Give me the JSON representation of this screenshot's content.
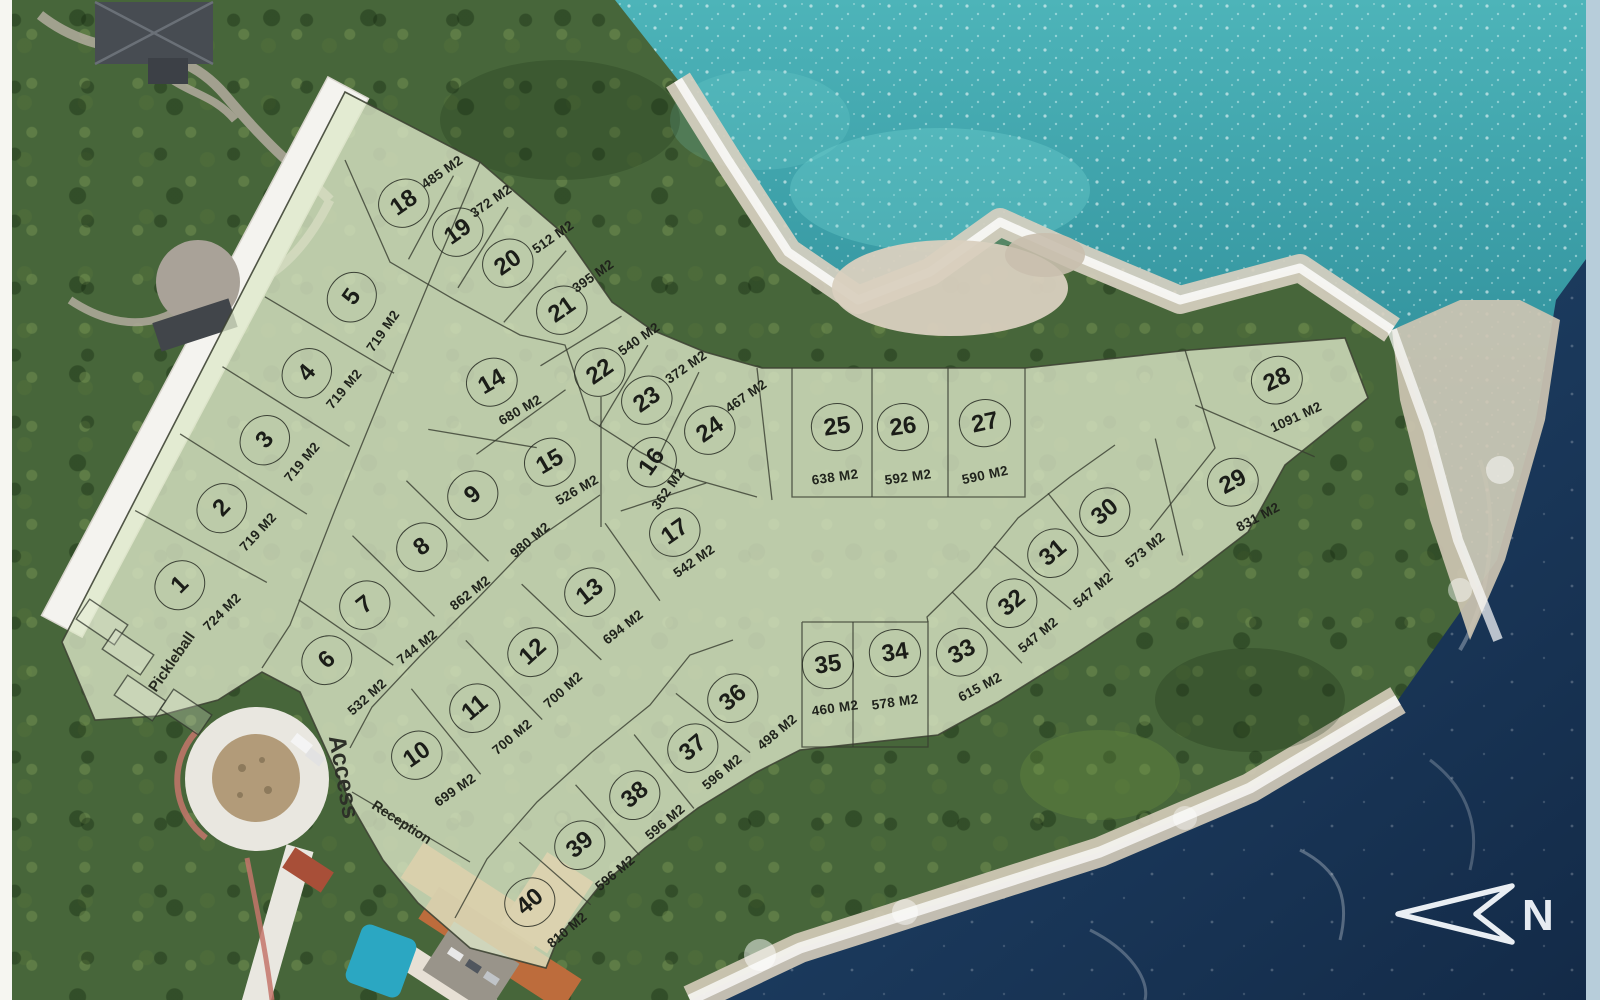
{
  "map": {
    "north_label": "N",
    "area_unit": "M2",
    "labels": {
      "pickleball": "Pickleball",
      "access": "Access",
      "reception": "Reception"
    }
  },
  "colors": {
    "overlay_fill": "#dde8c9",
    "plat_line": "#3a3f33",
    "ocean_turquoise": "#3fa8ad",
    "ocean_navy": "#1b3a5d",
    "rock": "#d7cfc0",
    "roof_terracotta": "#c87a46",
    "road_white": "#efede7"
  },
  "lots": [
    {
      "num": "1",
      "area": "724 M2",
      "x": 180,
      "y": 585,
      "rot": -45,
      "ax": 222,
      "ay": 612
    },
    {
      "num": "2",
      "area": "719 M2",
      "x": 222,
      "y": 508,
      "rot": -47,
      "ax": 258,
      "ay": 532
    },
    {
      "num": "3",
      "area": "719 M2",
      "x": 265,
      "y": 440,
      "rot": -50,
      "ax": 302,
      "ay": 462
    },
    {
      "num": "4",
      "area": "719 M2",
      "x": 307,
      "y": 373,
      "rot": -50,
      "ax": 344,
      "ay": 389
    },
    {
      "num": "5",
      "area": "719 M2",
      "x": 352,
      "y": 297,
      "rot": -55,
      "ax": 383,
      "ay": 331
    },
    {
      "num": "6",
      "area": "532 M2",
      "x": 327,
      "y": 660,
      "rot": -42,
      "ax": 367,
      "ay": 697
    },
    {
      "num": "7",
      "area": "744 M2",
      "x": 365,
      "y": 605,
      "rot": -38,
      "ax": 417,
      "ay": 647
    },
    {
      "num": "8",
      "area": "862 M2",
      "x": 422,
      "y": 547,
      "rot": -38,
      "ax": 470,
      "ay": 593
    },
    {
      "num": "9",
      "area": "980 M2",
      "x": 473,
      "y": 495,
      "rot": -40,
      "ax": 530,
      "ay": 540
    },
    {
      "num": "10",
      "area": "699 M2",
      "x": 417,
      "y": 755,
      "rot": -35,
      "ax": 455,
      "ay": 790
    },
    {
      "num": "11",
      "area": "700 M2",
      "x": 475,
      "y": 708,
      "rot": -40,
      "ax": 512,
      "ay": 737
    },
    {
      "num": "12",
      "area": "700 M2",
      "x": 533,
      "y": 652,
      "rot": -42,
      "ax": 563,
      "ay": 690
    },
    {
      "num": "13",
      "area": "694 M2",
      "x": 590,
      "y": 592,
      "rot": -38,
      "ax": 623,
      "ay": 627
    },
    {
      "num": "14",
      "area": "680 M2",
      "x": 492,
      "y": 382,
      "rot": -30,
      "ax": 520,
      "ay": 410
    },
    {
      "num": "15",
      "area": "526 M2",
      "x": 550,
      "y": 462,
      "rot": -30,
      "ax": 577,
      "ay": 490
    },
    {
      "num": "16",
      "area": "362 M2",
      "x": 652,
      "y": 462,
      "rot": -55,
      "ax": 668,
      "ay": 489
    },
    {
      "num": "17",
      "area": "542 M2",
      "x": 675,
      "y": 532,
      "rot": -35,
      "ax": 694,
      "ay": 561
    },
    {
      "num": "18",
      "area": "485 M2",
      "x": 404,
      "y": 203,
      "rot": -35,
      "ax": 442,
      "ay": 172
    },
    {
      "num": "19",
      "area": "372 M2",
      "x": 458,
      "y": 232,
      "rot": -35,
      "ax": 491,
      "ay": 201
    },
    {
      "num": "20",
      "area": "512 M2",
      "x": 508,
      "y": 263,
      "rot": -35,
      "ax": 553,
      "ay": 237
    },
    {
      "num": "21",
      "area": "395 M2",
      "x": 562,
      "y": 310,
      "rot": -35,
      "ax": 593,
      "ay": 276
    },
    {
      "num": "22",
      "area": "540 M2",
      "x": 600,
      "y": 372,
      "rot": -35,
      "ax": 639,
      "ay": 339
    },
    {
      "num": "23",
      "area": "372 M2",
      "x": 647,
      "y": 400,
      "rot": -35,
      "ax": 686,
      "ay": 367
    },
    {
      "num": "24",
      "area": "467 M2",
      "x": 710,
      "y": 430,
      "rot": -35,
      "ax": 746,
      "ay": 396
    },
    {
      "num": "25",
      "area": "638 M2",
      "x": 837,
      "y": 427,
      "rot": -8,
      "ax": 835,
      "ay": 477
    },
    {
      "num": "26",
      "area": "592 M2",
      "x": 903,
      "y": 427,
      "rot": -8,
      "ax": 908,
      "ay": 477
    },
    {
      "num": "27",
      "area": "590 M2",
      "x": 985,
      "y": 423,
      "rot": -12,
      "ax": 985,
      "ay": 475
    },
    {
      "num": "28",
      "area": "1091 M2",
      "x": 1277,
      "y": 380,
      "rot": -25,
      "ax": 1296,
      "ay": 417
    },
    {
      "num": "29",
      "area": "831 M2",
      "x": 1233,
      "y": 482,
      "rot": -28,
      "ax": 1258,
      "ay": 517
    },
    {
      "num": "30",
      "area": "573 M2",
      "x": 1105,
      "y": 512,
      "rot": -40,
      "ax": 1145,
      "ay": 550
    },
    {
      "num": "31",
      "area": "547 M2",
      "x": 1053,
      "y": 553,
      "rot": -40,
      "ax": 1093,
      "ay": 590
    },
    {
      "num": "32",
      "area": "547 M2",
      "x": 1012,
      "y": 603,
      "rot": -40,
      "ax": 1038,
      "ay": 635
    },
    {
      "num": "33",
      "area": "615 M2",
      "x": 962,
      "y": 652,
      "rot": -28,
      "ax": 980,
      "ay": 687
    },
    {
      "num": "34",
      "area": "578 M2",
      "x": 895,
      "y": 653,
      "rot": -8,
      "ax": 895,
      "ay": 702
    },
    {
      "num": "35",
      "area": "460 M2",
      "x": 828,
      "y": 665,
      "rot": -8,
      "ax": 835,
      "ay": 708
    },
    {
      "num": "36",
      "area": "498 M2",
      "x": 733,
      "y": 698,
      "rot": -40,
      "ax": 777,
      "ay": 732
    },
    {
      "num": "37",
      "area": "596 M2",
      "x": 693,
      "y": 748,
      "rot": -40,
      "ax": 722,
      "ay": 772
    },
    {
      "num": "38",
      "area": "596 M2",
      "x": 635,
      "y": 795,
      "rot": -40,
      "ax": 665,
      "ay": 822
    },
    {
      "num": "39",
      "area": "596 M2",
      "x": 580,
      "y": 845,
      "rot": -40,
      "ax": 615,
      "ay": 873
    },
    {
      "num": "40",
      "area": "810 M2",
      "x": 530,
      "y": 902,
      "rot": -40,
      "ax": 567,
      "ay": 930
    }
  ],
  "plat": {
    "boundary": [
      [
        345,
        92
      ],
      [
        480,
        162
      ],
      [
        565,
        235
      ],
      [
        612,
        302
      ],
      [
        652,
        330
      ],
      [
        705,
        352
      ],
      [
        762,
        368
      ],
      [
        1025,
        368
      ],
      [
        1190,
        350
      ],
      [
        1345,
        338
      ],
      [
        1368,
        398
      ],
      [
        1285,
        465
      ],
      [
        1248,
        532
      ],
      [
        1175,
        588
      ],
      [
        1078,
        652
      ],
      [
        998,
        702
      ],
      [
        938,
        735
      ],
      [
        800,
        750
      ],
      [
        757,
        772
      ],
      [
        698,
        808
      ],
      [
        645,
        848
      ],
      [
        598,
        888
      ],
      [
        558,
        938
      ],
      [
        546,
        968
      ],
      [
        470,
        948
      ],
      [
        418,
        903
      ],
      [
        383,
        860
      ],
      [
        352,
        806
      ],
      [
        332,
        763
      ],
      [
        300,
        692
      ],
      [
        262,
        672
      ],
      [
        218,
        700
      ],
      [
        158,
        716
      ],
      [
        95,
        720
      ],
      [
        62,
        642
      ]
    ],
    "polylines": [
      [
        [
          480,
          162
        ],
        [
          430,
          280
        ],
        [
          382,
          395
        ],
        [
          335,
          510
        ],
        [
          290,
          625
        ],
        [
          262,
          668
        ]
      ],
      [
        [
          345,
          160
        ],
        [
          390,
          262
        ],
        [
          455,
          300
        ],
        [
          520,
          335
        ],
        [
          565,
          345
        ],
        [
          590,
          420
        ],
        [
          640,
          452
        ],
        [
          690,
          478
        ],
        [
          757,
          497
        ]
      ],
      [
        [
          600,
          495
        ],
        [
          531,
          543
        ],
        [
          477,
          599
        ],
        [
          420,
          656
        ],
        [
          372,
          707
        ],
        [
          350,
          748
        ]
      ],
      [
        [
          733,
          640
        ],
        [
          690,
          655
        ],
        [
          650,
          705
        ],
        [
          592,
          752
        ],
        [
          537,
          802
        ],
        [
          487,
          859
        ],
        [
          455,
          918
        ]
      ],
      [
        [
          792,
          368
        ],
        [
          792,
          497
        ],
        [
          1025,
          497
        ],
        [
          1025,
          368
        ]
      ],
      [
        [
          872,
          368
        ],
        [
          872,
          497
        ]
      ],
      [
        [
          948,
          368
        ],
        [
          948,
          497
        ]
      ],
      [
        [
          802,
          622
        ],
        [
          802,
          747
        ],
        [
          928,
          747
        ],
        [
          928,
          622
        ],
        [
          802,
          622
        ]
      ],
      [
        [
          853,
          622
        ],
        [
          853,
          747
        ]
      ],
      [
        [
          757,
          368
        ],
        [
          772,
          500
        ]
      ],
      [
        [
          1185,
          350
        ],
        [
          1215,
          448
        ],
        [
          1150,
          530
        ]
      ],
      [
        [
          1115,
          445
        ],
        [
          1070,
          477
        ],
        [
          1018,
          518
        ],
        [
          977,
          568
        ],
        [
          927,
          617
        ],
        [
          928,
          622
        ]
      ],
      [
        [
          352,
          792
        ],
        [
          470,
          862
        ]
      ]
    ],
    "dividers": [
      [
        "1",
        "2",
        150
      ],
      [
        "2",
        "3",
        150
      ],
      [
        "3",
        "4",
        150
      ],
      [
        "4",
        "5",
        150
      ],
      [
        "6",
        "7",
        115
      ],
      [
        "7",
        "8",
        115
      ],
      [
        "8",
        "9",
        115
      ],
      [
        "9",
        "14",
        110
      ],
      [
        "10",
        "11",
        110
      ],
      [
        "11",
        "12",
        110
      ],
      [
        "12",
        "13",
        110
      ],
      [
        "13",
        "17",
        95
      ],
      [
        "14",
        "15",
        110
      ],
      [
        "15",
        "16",
        130
      ],
      [
        "16",
        "17",
        90
      ],
      [
        "18",
        "19",
        95
      ],
      [
        "19",
        "20",
        95
      ],
      [
        "20",
        "21",
        95
      ],
      [
        "21",
        "22",
        95
      ],
      [
        "22",
        "23",
        95
      ],
      [
        "23",
        "24",
        95
      ],
      [
        "28",
        "29",
        130
      ],
      [
        "29",
        "30",
        120
      ],
      [
        "30",
        "31",
        100
      ],
      [
        "31",
        "32",
        100
      ],
      [
        "32",
        "33",
        100
      ],
      [
        "36",
        "37",
        95
      ],
      [
        "37",
        "38",
        95
      ],
      [
        "38",
        "39",
        95
      ],
      [
        "39",
        "40",
        95
      ]
    ],
    "courts": [
      {
        "cx": 102,
        "cy": 622,
        "rot": 34
      },
      {
        "cx": 128,
        "cy": 652,
        "rot": 34
      },
      {
        "cx": 140,
        "cy": 698,
        "rot": 34
      },
      {
        "cx": 186,
        "cy": 712,
        "rot": 34
      }
    ]
  }
}
